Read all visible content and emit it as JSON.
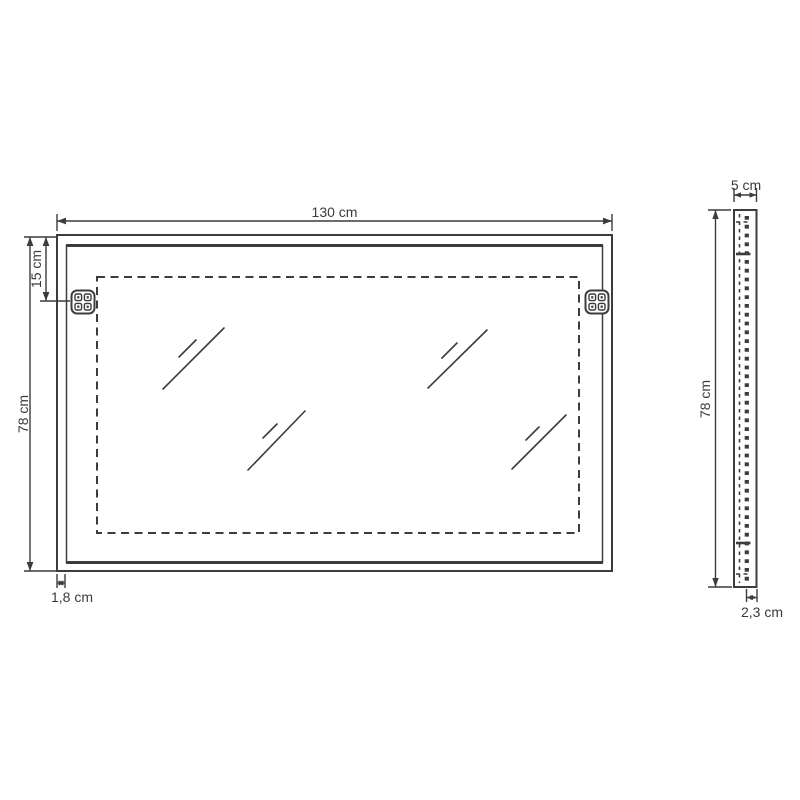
{
  "title": "Wall mirror technical dimension drawing",
  "colors": {
    "line": "#3c3c3c",
    "text": "#3b3b3b",
    "background": "#ffffff"
  },
  "icons": {
    "bracket": "mounting-bracket-icon",
    "shine": "mirror-shine-icon"
  },
  "views": {
    "front": {
      "name": "mirror front view",
      "label_width": "130 cm",
      "label_height": "78 cm",
      "label_bracket_offset": "15 cm",
      "label_frame_depth": "1,8 cm"
    },
    "side": {
      "name": "mirror side view",
      "label_depth": "5 cm",
      "label_height": "78 cm",
      "label_back_offset": "2,3 cm"
    }
  }
}
